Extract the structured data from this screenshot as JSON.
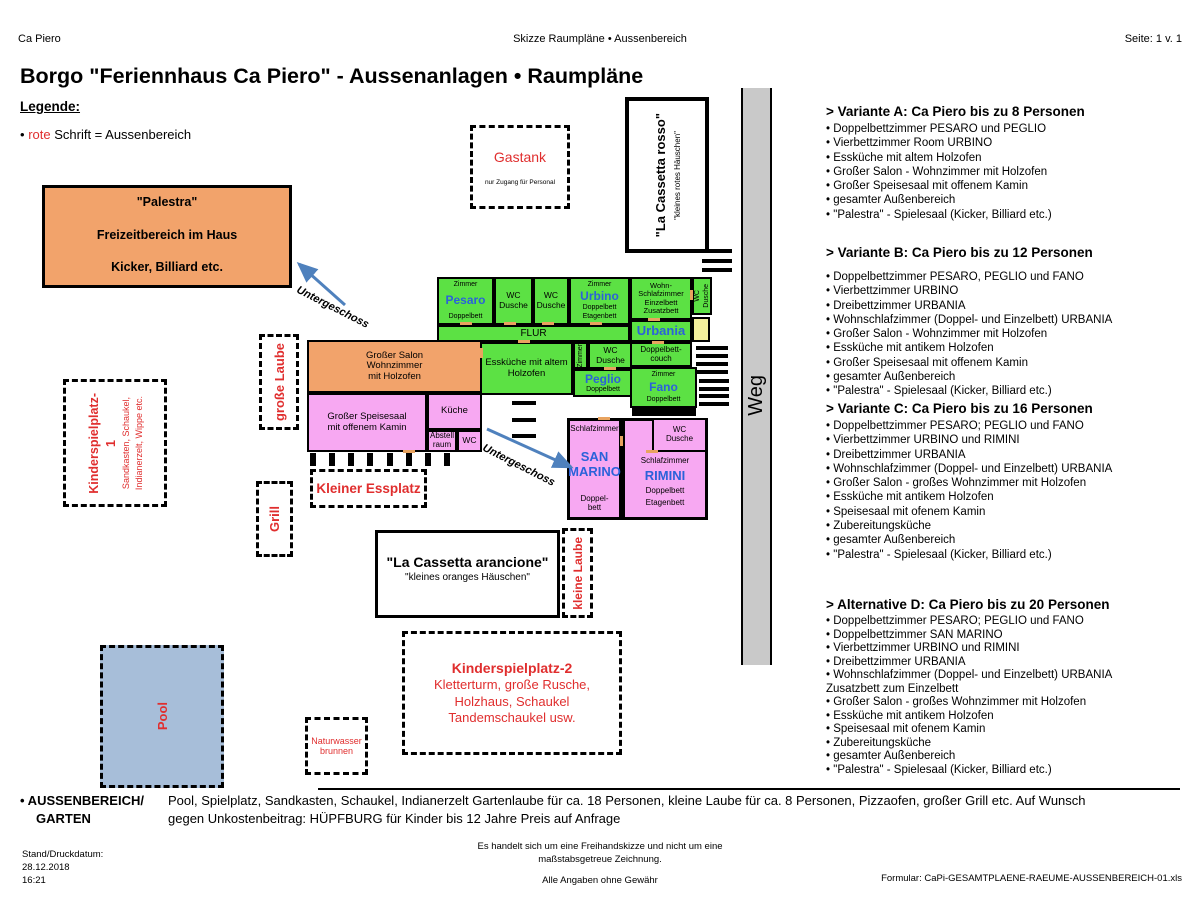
{
  "header": {
    "left": "Ca Piero",
    "center": "Skizze Raumpläne • Aussenbereich",
    "right": "Seite: 1 v. 1"
  },
  "title": "Borgo \"Feriennhaus Ca Piero\" - Aussenanlagen • Raumpläne",
  "legend": {
    "heading": "Legende:",
    "bullet": "•",
    "red_word": "rote",
    "rest": "Schrift = Aussenbereich"
  },
  "palestra": {
    "line1": "\"Palestra\"",
    "line2": "Freizeitbereich im Haus",
    "line3": "Kicker, Billiard etc."
  },
  "gastank": {
    "name": "Gastank",
    "note": "nur Zugang für Personal"
  },
  "cassetta_rosso": {
    "name": "\"La Cassetta rosso\"",
    "sub": "\"kleines rotes Häuschen\""
  },
  "cassetta_arancione": {
    "name": "\"La Cassetta arancione\"",
    "sub": "\"kleines oranges Häuschen\""
  },
  "weg": "Weg",
  "outdoor": {
    "grosse_laube": "große Laube",
    "kleine_laube": "kleine Laube",
    "grill": "Grill",
    "pool": "Pool",
    "brunnen_l1": "Naturwasser",
    "brunnen_l2": "brunnen",
    "kleiner_essplatz": "Kleiner Essplatz",
    "untergeschoss1": "Untergeschoss",
    "untergeschoss2": "Untergeschoss",
    "kinderspielplatz1": {
      "title": "Kinderspielplatz-",
      "number": "1",
      "desc1": "Sandkasten, Schaukel,",
      "desc2": "Indianerzelt, Wippe etc."
    },
    "kinderspielplatz2": {
      "title": "Kinderspielplatz-2",
      "line1": "Kletterturm, große Rusche,",
      "line2": "Holzhaus, Schaukel",
      "line3": "Tandemschaukel usw."
    }
  },
  "plan": {
    "pesaro": {
      "top": "Zimmer",
      "name": "Pesaro",
      "b1": "Doppelbett"
    },
    "wc_a": {
      "l1": "WC",
      "l2": "Dusche"
    },
    "wc_b": {
      "l1": "WC",
      "l2": "Dusche"
    },
    "urbino": {
      "top": "Zimmer",
      "name": "Urbino",
      "b1": "Doppelbett",
      "b2": "Etagenbett"
    },
    "wohnschlaf": {
      "l1": "Wohn-",
      "l2": "Schlafzimmer",
      "l3": "Einzelbett",
      "l4": "Zusatzbett"
    },
    "wc_vert": {
      "l1": "WC",
      "l2": "Dusche"
    },
    "flur": "FLUR",
    "urbania": {
      "name": "Urbania"
    },
    "dbcouch": "Doppelbett-couch",
    "esskueche": {
      "l1": "Essküche mit altem",
      "l2": "Holzofen"
    },
    "zimmer_vert": "Zimmer",
    "wc_c": {
      "l1": "WC",
      "l2": "Dusche"
    },
    "peglio": {
      "name": "Peglio",
      "b1": "Doppelbett"
    },
    "fano": {
      "top": "Zimmer",
      "name": "Fano",
      "b1": "Doppelbett"
    },
    "salon": {
      "l1": "Großer Salon",
      "l2": "Wohnzimmer",
      "l3": "mit Holzofen"
    },
    "speisesaal": {
      "l1": "Großer Speisesaal",
      "l2": "mit offenem Kamin"
    },
    "kueche": "Küche",
    "abstell": {
      "l1": "Abstell",
      "l2": "raum"
    },
    "wc_d": "WC",
    "san_marino": {
      "top": "Schlafzimmer",
      "n1": "SAN",
      "n2": "MARINO",
      "b1": "Doppel-",
      "b2": "bett"
    },
    "rimini": {
      "top": "Schlafzimmer",
      "name": "RIMINI",
      "b1": "Doppelbett",
      "b2": "Etagenbett"
    },
    "wc_e": {
      "l1": "WC",
      "l2": "Dusche"
    }
  },
  "variants": [
    {
      "heading": "> Variante A: Ca Piero bis zu 8 Personen",
      "items": [
        "Doppelbettzimmer PESARO und PEGLIO",
        "Vierbettzimmer Room URBINO",
        "Essküche mit altem Holzofen",
        "Großer Salon - Wohnzimmer mit Holzofen",
        "Großer Speisesaal mit offenem Kamin",
        "gesamter Außenbereich",
        "\"Palestra\" - Spielesaal (Kicker, Billiard etc.)"
      ]
    },
    {
      "heading": "> Variante B: Ca Piero bis zu 12 Personen",
      "items": [
        "Doppelbettzimmer PESARO, PEGLIO und FANO",
        "Vierbettzimmer URBINO",
        "Dreibettzimmer URBANIA",
        "Wohnschlafzimmer (Doppel- und Einzelbett) URBANIA",
        "Großer Salon - Wohnzimmer mit Holzofen",
        "Essküche mit antikem Holzofen",
        "Großer Speisesaal mit offenem Kamin",
        "gesamter Außenbereich",
        "\"Palestra\" - Spielesaal (Kicker, Billiard etc.)"
      ]
    },
    {
      "heading": "> Variante C: Ca Piero bis zu 16 Personen",
      "items": [
        "Doppelbettzimmer PESARO; PEGLIO und FANO",
        "Vierbettzimmer URBINO und RIMINI",
        "Dreibettzimmer URBANIA",
        "Wohnschlafzimmer (Doppel- und Einzelbett) URBANIA",
        "Großer Salon - großes Wohnzimmer mit Holzofen",
        "Essküche mit antikem Holzofen",
        "Speisesaal mit ofenem Kamin",
        "Zubereitungsküche",
        "gesamter Außenbereich",
        "\"Palestra\" - Spielesaal (Kicker, Billiard etc.)"
      ]
    },
    {
      "heading": "> Alternative D: Ca Piero bis zu 20 Personen",
      "items": [
        "Doppelbettzimmer PESARO; PEGLIO und FANO",
        "Doppelbettzimmer SAN MARINO",
        "Vierbettzimmer URBINO und RIMINI",
        "Dreibettzimmer URBANIA",
        "Wohnschlafzimmer (Doppel- und Einzelbett) URBANIA\nZusatzbett zum Einzelbett",
        "Großer Salon - großes Wohnzimmer mit Holzofen",
        "Essküche mit antikem Holzofen",
        "Speisesaal mit ofenem Kamin",
        "Zubereitungsküche",
        "gesamter Außenbereich",
        "\"Palestra\" - Spielesaal (Kicker, Billiard etc.)"
      ]
    }
  ],
  "bottom": {
    "label1": "• AUSSENBEREICH/",
    "label2": "GARTEN",
    "text1": "Pool, Spielplatz, Sandkasten, Schaukel, Indianerzelt  Gartenlaube für ca. 18 Personen, kleine Laube für  ca. 8 Personen, Pizzaofen, großer Grill etc. Auf Wunsch",
    "text2": "gegen Unkostenbeitrag:  HÜPFBURG für Kinder bis 12 Jahre Preis auf Anfrage"
  },
  "footer": {
    "stand_label": "Stand/Druckdatum:",
    "date": "28.12.2018",
    "time": "16:21",
    "note1": "Es handelt  sich um eine Freihandskizze und nicht um eine",
    "note2": "maßstabsgetreue Zeichnung.",
    "note3": "Alle Angaben ohne Gewähr",
    "formular": "Formular: CaPi-GESAMTPLAENE-RAEUME-AUSSENBEREICH-01.xls"
  },
  "colors": {
    "outdoor_red": "#e02e2e",
    "room_green": "#5ce144",
    "room_pink": "#f7a8f2",
    "room_orange": "#f2a36b",
    "pool_blue": "#a7bed9",
    "path_gray": "#c9c9c9",
    "name_blue": "#2b62d9",
    "arrow_blue": "#4f81bd",
    "door_tan": "#e8a35f",
    "entry_yellow": "#f4f09c"
  }
}
